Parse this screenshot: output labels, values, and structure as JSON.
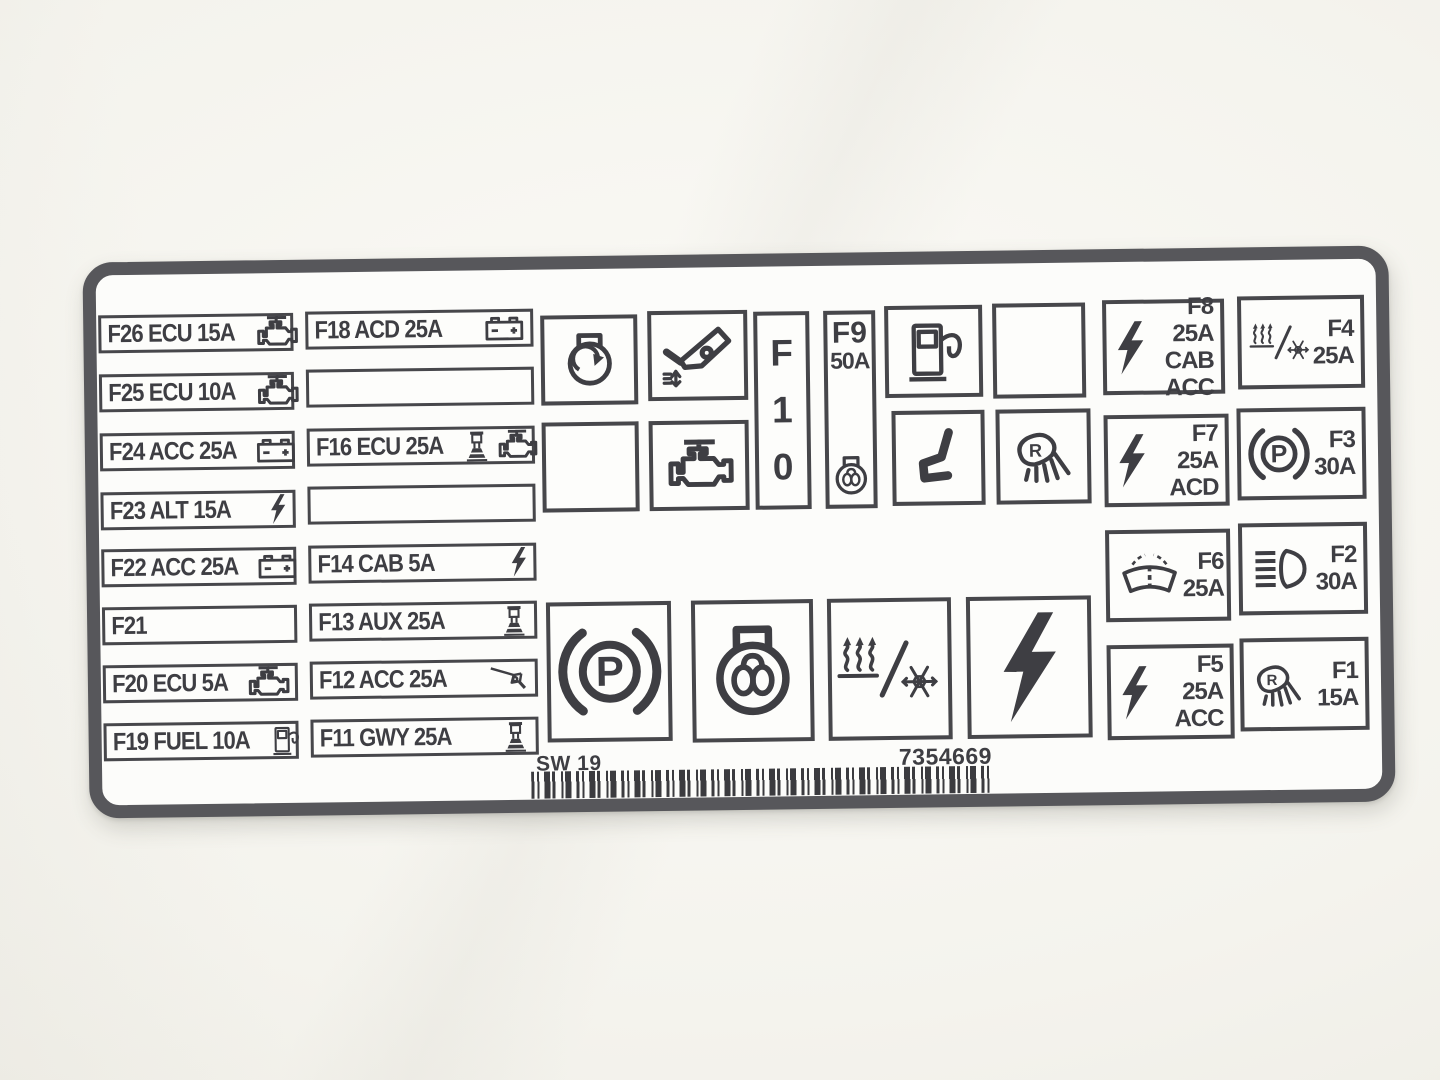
{
  "colors": {
    "ink": "#3e3e43",
    "label_border": "#57575b",
    "label_bg": "#fcfcfa",
    "photo_bg": "#f3f2ec"
  },
  "footer": {
    "code": "SW 19",
    "part_number": "7354669"
  },
  "left_column": [
    {
      "text": "F26 ECU 15A",
      "icon": "engine-icon"
    },
    {
      "text": "F25 ECU 10A",
      "icon": "engine-icon"
    },
    {
      "text": "F24 ACC 25A",
      "icon": "battery-icon"
    },
    {
      "text": "F23 ALT 15A",
      "icon": "lightning-icon"
    },
    {
      "text": "F22 ACC 25A",
      "icon": "battery-icon"
    },
    {
      "text": "F21",
      "icon": ""
    },
    {
      "text": "F20 ECU 5A",
      "icon": "engine-icon"
    },
    {
      "text": "F19 FUEL 10A",
      "icon": "fuel-pump-icon"
    }
  ],
  "second_column": [
    {
      "text": "F18 ACD 25A",
      "icons": [
        "battery-icon"
      ]
    },
    {
      "text": "",
      "icons": []
    },
    {
      "text": "F16 ECU 25A",
      "icons": [
        "pedestal-machine-icon",
        "engine-icon"
      ]
    },
    {
      "text": "",
      "icons": []
    },
    {
      "text": "F14 CAB 5A",
      "icons": [
        "lightning-icon"
      ]
    },
    {
      "text": "F13 AUX 25A",
      "icons": [
        "pedestal-machine-icon"
      ]
    },
    {
      "text": "F12 ACC 25A",
      "icons": [
        "tipping-tray-icon"
      ]
    },
    {
      "text": "F11 GWY 25A",
      "icons": [
        "pedestal-machine-icon"
      ]
    }
  ],
  "center": {
    "f10": {
      "char1": "F",
      "char2": "1",
      "char3": "0"
    },
    "f9": {
      "id": "F9",
      "amp": "50A",
      "icon": "glow-plug-icon"
    },
    "icon_boxes": [
      "alternator-icon",
      "cab-tilt-icon",
      "fuel-pump-icon",
      "blank",
      "blank",
      "engine-icon",
      "seat-icon",
      "reverse-lamp-icon"
    ],
    "large_icon_boxes": [
      "parking-brake-icon",
      "glow-plug-icon",
      "heater-snowflake-icon",
      "lightning-icon"
    ]
  },
  "right_grid": [
    {
      "id": "F8",
      "amp": "25A",
      "circuit": "CAB ACC",
      "icon": "lightning-icon"
    },
    {
      "id": "F4",
      "amp": "25A",
      "circuit": "",
      "icon": "heater-snowflake-icon"
    },
    {
      "id": "F7",
      "amp": "25A",
      "circuit": "ACD",
      "icon": "lightning-icon"
    },
    {
      "id": "F3",
      "amp": "30A",
      "circuit": "",
      "icon": "parking-brake-icon"
    },
    {
      "id": "F6",
      "amp": "25A",
      "circuit": "",
      "icon": "windshield-wiper-icon"
    },
    {
      "id": "F2",
      "amp": "30A",
      "circuit": "",
      "icon": "headlight-icon"
    },
    {
      "id": "F5",
      "amp": "25A",
      "circuit": "ACC",
      "icon": "lightning-icon"
    },
    {
      "id": "F1",
      "amp": "15A",
      "circuit": "",
      "icon": "reverse-lamp-icon"
    }
  ]
}
